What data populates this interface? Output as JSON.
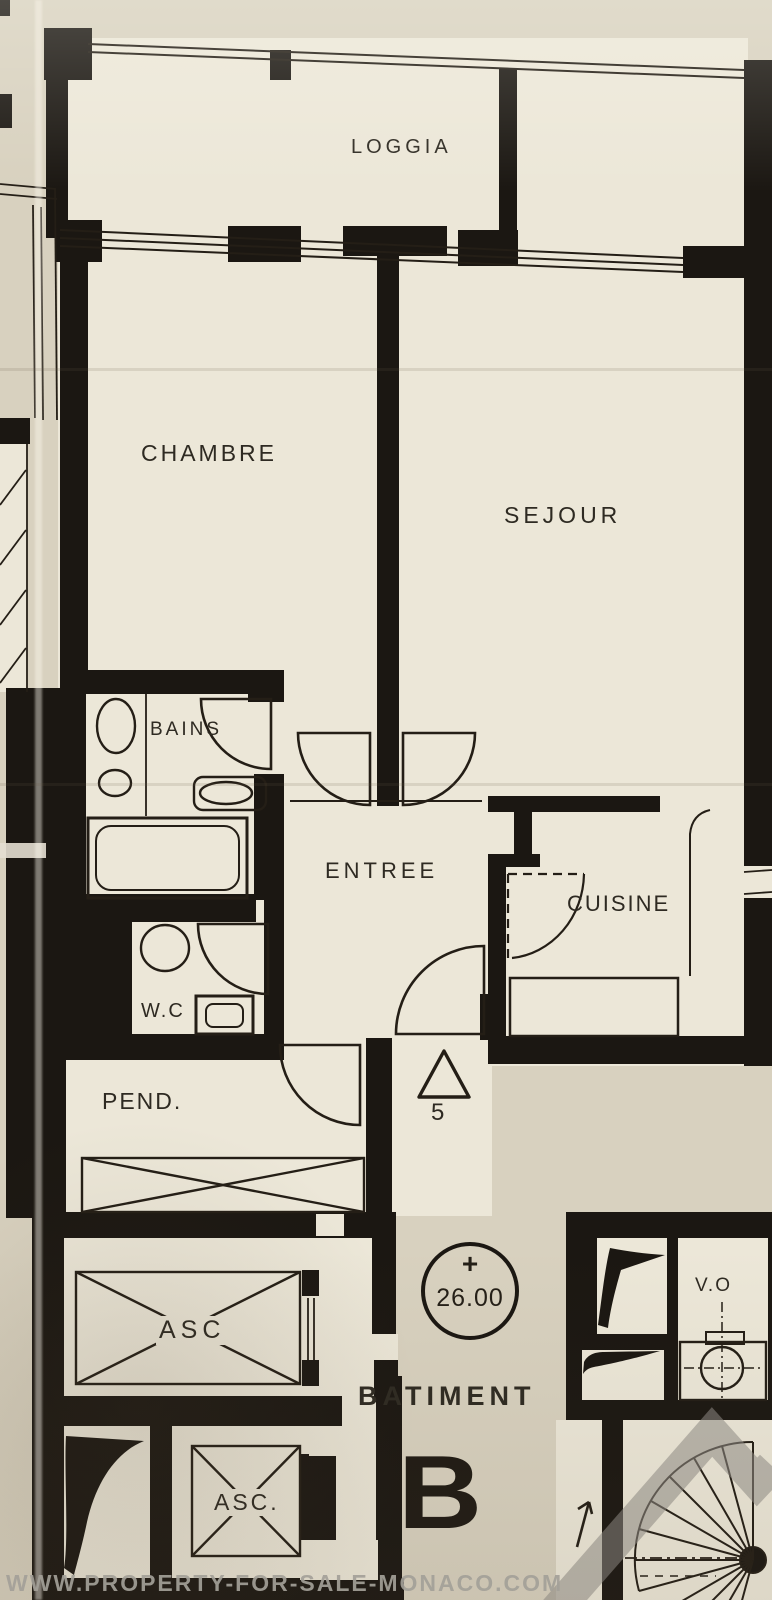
{
  "colors": {
    "ink": "#1b1712",
    "paper": "#d8d1bf",
    "room_fill": "#ece7d8",
    "watermark_gray": "#8f8c86"
  },
  "labels": {
    "loggia": "LOGGIA",
    "chambre": "CHAMBRE",
    "sejour": "SEJOUR",
    "bains": "BAINS",
    "entree": "ENTREE",
    "cuisine": "CUISINE",
    "wc": "W.C",
    "pend": "PEND.",
    "asc_upper": "ASC",
    "asc_lower": "ASC.",
    "vo": "V.O",
    "batiment": "BATIMENT",
    "building_letter": "B",
    "level_plus": "+",
    "level_value": "26.00",
    "apartment_number": "5"
  },
  "watermark": {
    "url": "WWW.PROPERTY-FOR-SALE-MONACO.COM"
  },
  "icons": {
    "fixtures": [
      "bathtub-icon",
      "washbasin-icon",
      "bidet-icon",
      "toilet-icon",
      "door-swing-icon",
      "elevator-shaft-icon",
      "wardrobe-icon",
      "garbage-chute-icon",
      "spiral-staircase-icon",
      "duct-icon",
      "stair-direction-arrow-icon",
      "level-marker-icon",
      "entrance-triangle-icon"
    ]
  }
}
